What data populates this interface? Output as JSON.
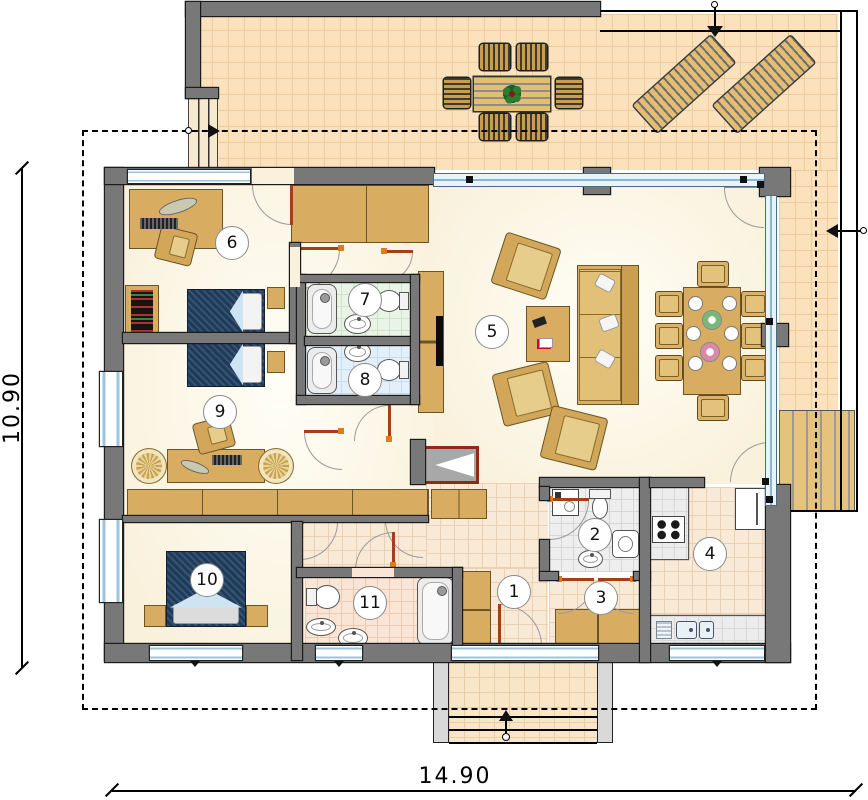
{
  "plan": {
    "type": "architectural-floor-plan",
    "dimension_labels": {
      "vertical": "10.90",
      "horizontal": "14.90"
    },
    "rooms": [
      {
        "number": "1"
      },
      {
        "number": "2"
      },
      {
        "number": "3"
      },
      {
        "number": "4"
      },
      {
        "number": "5"
      },
      {
        "number": "6"
      },
      {
        "number": "7"
      },
      {
        "number": "8"
      },
      {
        "number": "9"
      },
      {
        "number": "10"
      },
      {
        "number": "11"
      }
    ],
    "colors": {
      "wall": "#787878",
      "terrace_tile": "#fbe2bd",
      "interior_floor": "#f9f1dc",
      "wood_furniture": "#d8ad62",
      "bed_cover": "#1e3b5b",
      "glazing": "#cfe4f2",
      "door_leaf": "#a63e1c",
      "door_hinge_marker": "#e07a1e",
      "bath_green_tile": "#e9f3e6",
      "bath_blue_tile": "#e3f0f9",
      "bath_pink_tile": "#f9e5d6",
      "wc_grey_tile": "#eeeeee"
    },
    "furniture_icons": [
      "outdoor-dining-table",
      "outdoor-chair",
      "sun-lounger",
      "sofa",
      "armchair",
      "coffee-table",
      "dining-table",
      "dining-chair",
      "plate",
      "tv",
      "wardrobe",
      "fireplace",
      "double-bed",
      "nightstand",
      "desk",
      "desk-chair",
      "desk-lamp",
      "bookshelf",
      "round-rug",
      "bathtub",
      "washbasin",
      "toilet",
      "bidet",
      "washing-machine",
      "fridge",
      "stove",
      "kitchen-sink",
      "kitchen-counter",
      "entrance-steps"
    ]
  }
}
